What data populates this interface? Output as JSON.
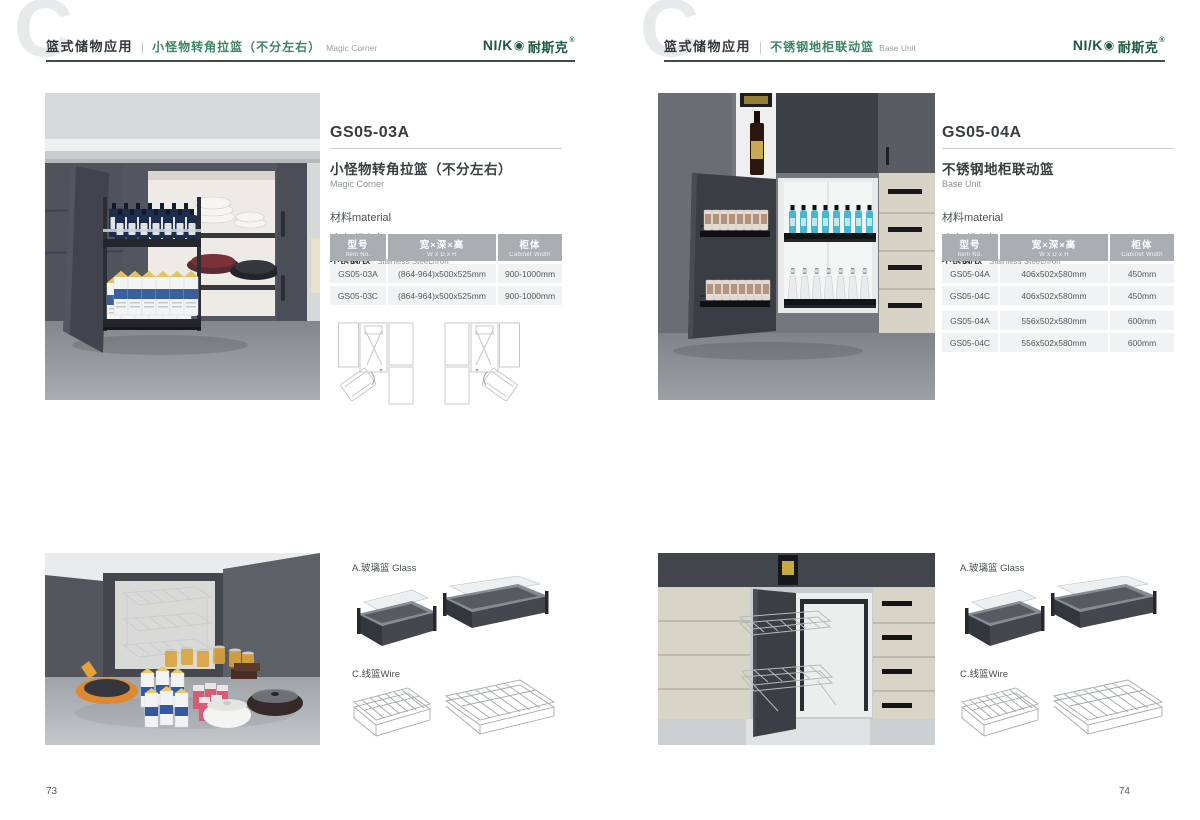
{
  "brand": {
    "logo_latin": "NI/K",
    "logo_mark": "◉",
    "logo_mark_icon": "target-circle-icon",
    "logo_cn": "耐斯克",
    "logo_reg": "®",
    "logo_color": "#1c5b40"
  },
  "colors": {
    "accent_green": "#3c8565",
    "header_rule": "#3f4e46",
    "table_header_bg": "#a9aeb3",
    "table_row_bg": "#f1f2f3",
    "watermark_gray": "#e7e9ea"
  },
  "page_left": {
    "page_number": "73",
    "header": {
      "watermark": "C",
      "category": "篮式储物应用",
      "separator": "|",
      "title_cn": "小怪物转角拉篮（不分左右）",
      "title_en": "Magic Corner"
    },
    "product": {
      "model": "GS05-03A",
      "name_cn": "小怪物转角拉篮（不分左右）",
      "name_en": "Magic Corner",
      "material_label": "材料material",
      "materials": [
        {
          "cn": "玻璃+铝合金",
          "en": "Glass+Aluminum"
        },
        {
          "cn": "不锈钢/铁",
          "en": "Stainless SteeL/Iron"
        }
      ]
    },
    "table": {
      "headers": [
        {
          "cn": "型号",
          "en": "Item No."
        },
        {
          "cn": "宽×深×高",
          "en": "W x D x H"
        },
        {
          "cn": "柜体",
          "en": "Cabinet Width"
        }
      ],
      "rows": [
        {
          "model": "GS05-03A",
          "size": "(864-964)x500x525mm",
          "cabinet": "900-1000mm"
        },
        {
          "model": "GS05-03C",
          "size": "(864-964)x500x525mm",
          "cabinet": "900-1000mm"
        }
      ]
    },
    "accessories": {
      "glass_label": "A.玻璃篮 Glass",
      "wire_label": "C.线篮Wire"
    }
  },
  "page_right": {
    "page_number": "74",
    "header": {
      "watermark": "C",
      "category": "篮式储物应用",
      "separator": "|",
      "title_cn": "不锈钢地柜联动篮",
      "title_en": "Base Unit"
    },
    "product": {
      "model": "GS05-04A",
      "name_cn": "不锈钢地柜联动篮",
      "name_en": "Base Unit",
      "material_label": "材料material",
      "materials": [
        {
          "cn": "玻璃+铝合金",
          "en": "Glass+Aluminum"
        },
        {
          "cn": "不锈钢/铁",
          "en": "Stainless SteeL/Iron"
        }
      ]
    },
    "table": {
      "headers": [
        {
          "cn": "型号",
          "en": "Item No."
        },
        {
          "cn": "宽×深×高",
          "en": "W x D x H"
        },
        {
          "cn": "柜体",
          "en": "Cabinet Width"
        }
      ],
      "rows": [
        {
          "model": "GS05-04A",
          "size": "406x502x580mm",
          "cabinet": "450mm"
        },
        {
          "model": "GS05-04C",
          "size": "406x502x580mm",
          "cabinet": "450mm"
        },
        {
          "model": "GS05-04A",
          "size": "556x502x580mm",
          "cabinet": "600mm"
        },
        {
          "model": "GS05-04C",
          "size": "556x502x580mm",
          "cabinet": "600mm"
        }
      ]
    },
    "accessories": {
      "glass_label": "A.玻璃篮 Glass",
      "wire_label": "C.线篮Wire"
    }
  }
}
